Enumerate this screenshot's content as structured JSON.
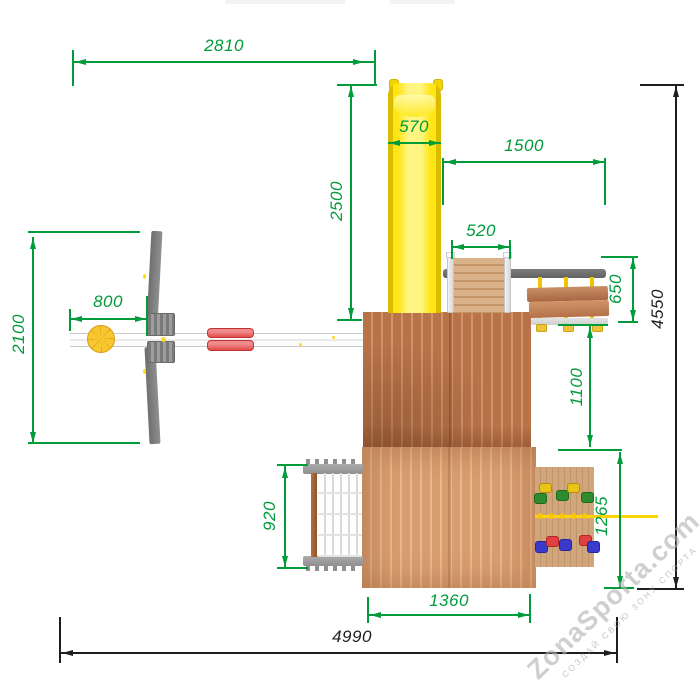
{
  "dims": {
    "swing_width": "2810",
    "slide_length": "2500",
    "slide_width": "570",
    "right_extension": "1500",
    "ramp_width": "520",
    "tire_offset": "800",
    "swing_depth": "2100",
    "bench_depth": "650",
    "bench_gap": "1100",
    "net_width": "920",
    "right_section_depth": "1265",
    "roof_width": "1360",
    "total_width": "4990",
    "total_depth": "4550"
  },
  "watermark": {
    "brand": "ZonaSporta.com",
    "tagline": "СОЗДАЙ СВОЮ ЗОНУ СПОРТА"
  },
  "colors": {
    "dimension_green": "#009b3a",
    "dimension_black": "#1e1e1e",
    "slide_yellow": "#ffe513",
    "roof_upper_brown": "#bd7850",
    "roof_lower_brown": "#d89d6f",
    "metal_gray": "#7d7d7d",
    "swing_seat_red": "#ea5050",
    "hardware_yellow": "#f0c400"
  }
}
